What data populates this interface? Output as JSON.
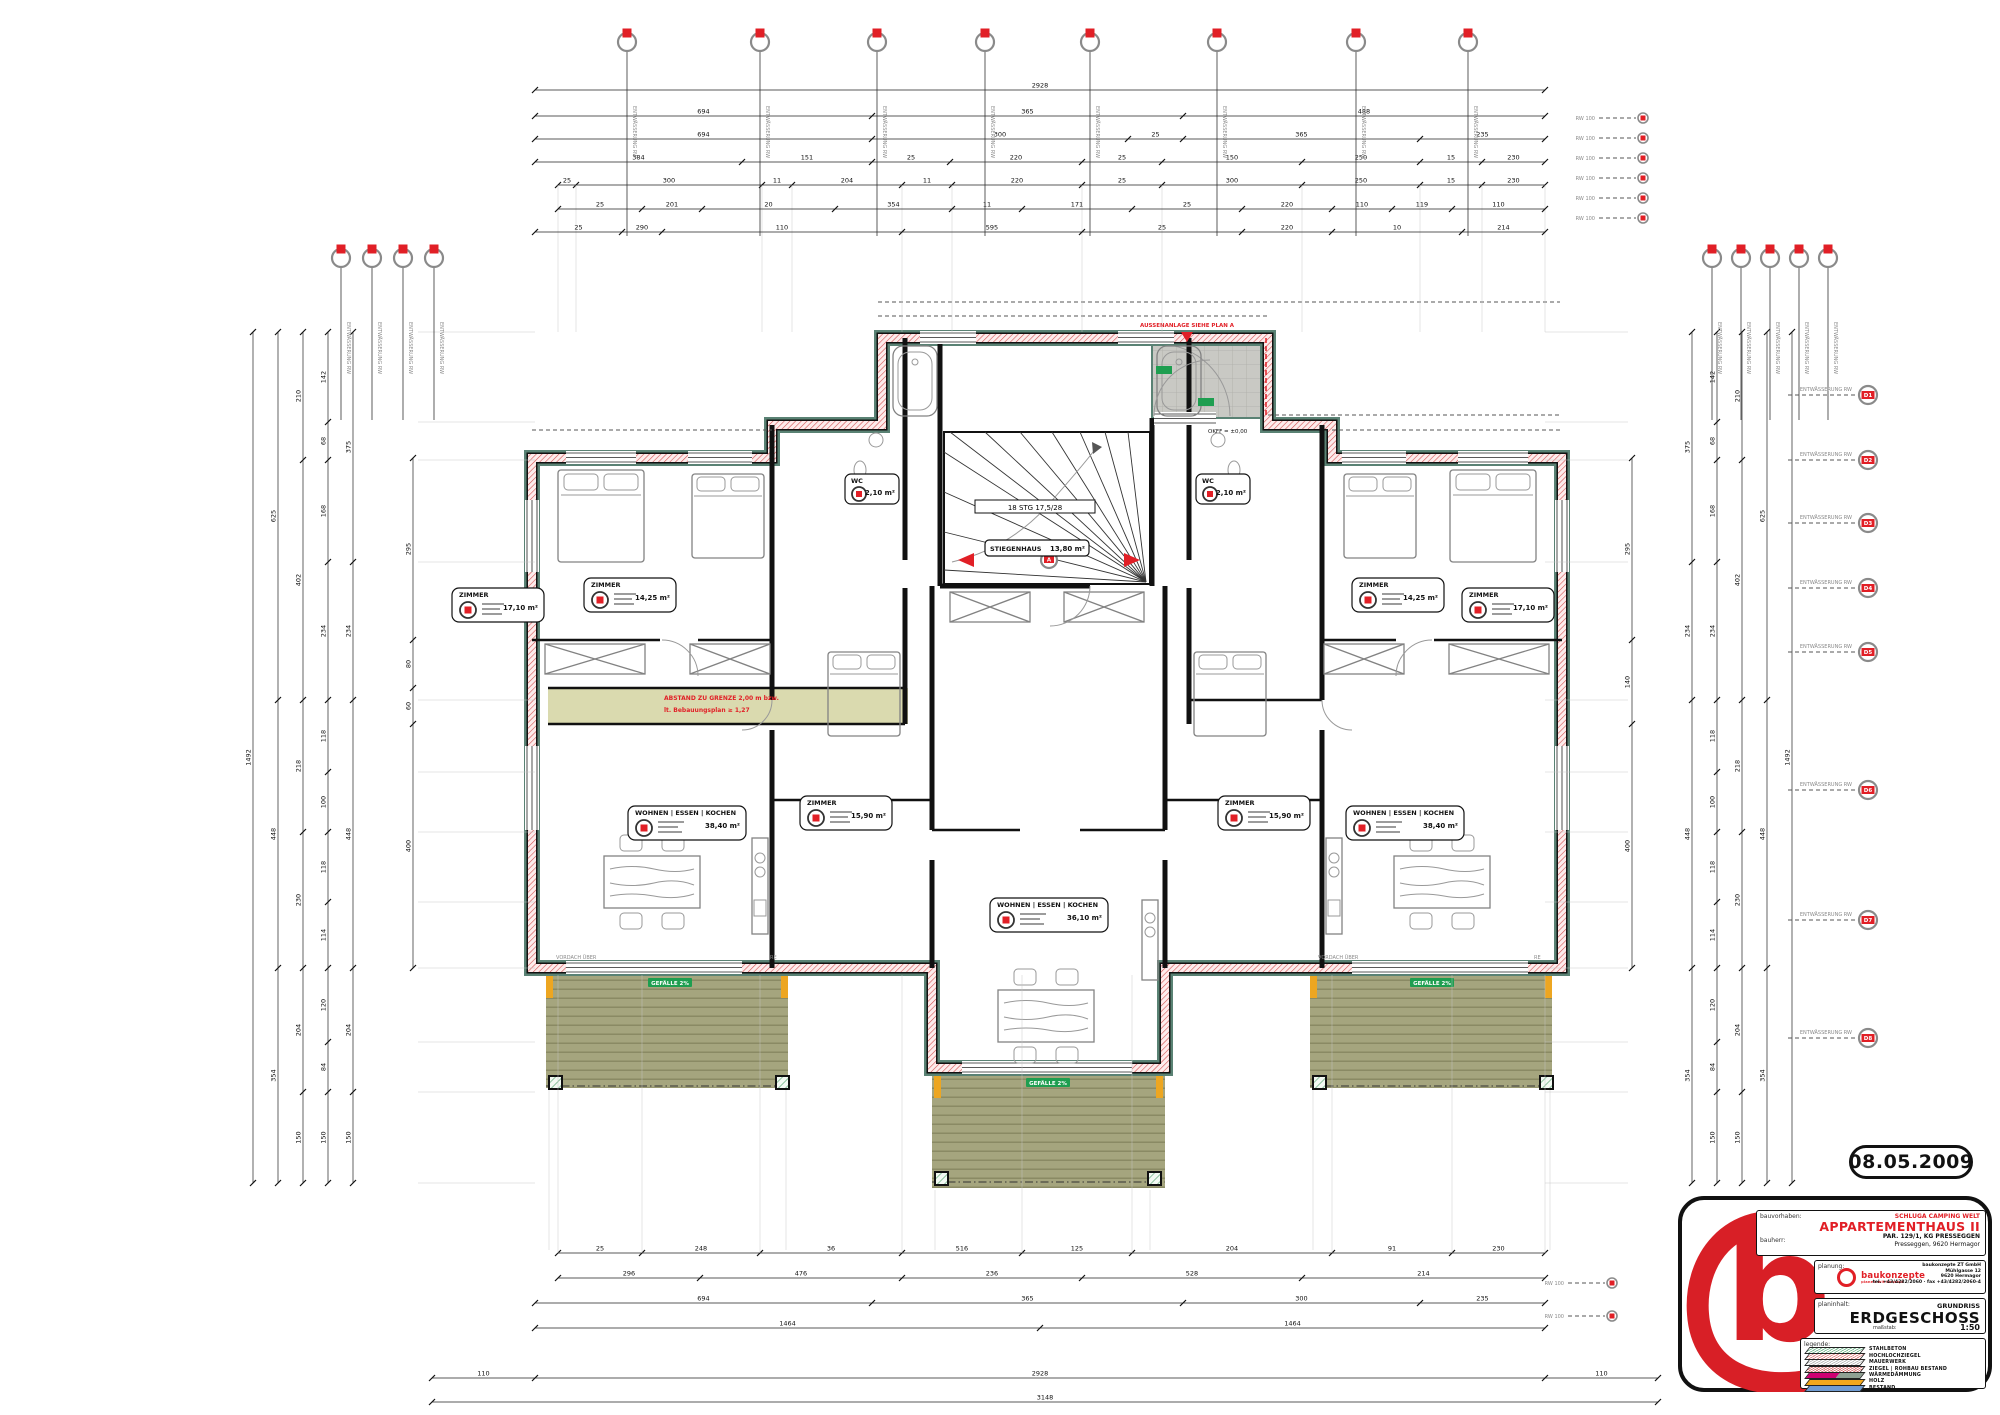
{
  "meta": {
    "date_stamp": "08.05.2009"
  },
  "titleblock": {
    "bauvorhaben_label": "bauvorhaben:",
    "bauherr_label": "bauherr:",
    "client": "SCHLUGA CAMPING WELT",
    "project_title": "APPARTEMENTHAUS II",
    "project_sub1": "PAR. 129/1, KG PRESSEGGEN",
    "project_sub2": "Presseggen, 9620 Hermagor",
    "planung_label": "planung:",
    "logo_text": "baukonzepte",
    "logo_sub": "planen mit konzept",
    "firm_line1": "baukonzepte ZT GmbH",
    "firm_line2": "Mühlgasse 12",
    "firm_line3": "9620 Hermagor",
    "firm_line4": "tel. +43/4282/2060 · fax +43/4282/2060-4",
    "planinhalt_label": "planinhalt:",
    "drawing_type": "GRUNDRISS",
    "drawing_title": "ERDGESCHOSS",
    "massstab_label": "maßstab:",
    "scale": "1:50",
    "legende_label": "legende:",
    "legend": [
      {
        "label": "STAHLBETON",
        "color": "#58a978"
      },
      {
        "label": "HOCHLOCHZIEGEL",
        "color": "#d96a6a"
      },
      {
        "label": "MAUERWERK",
        "color": "#ababab"
      },
      {
        "label": "ZIEGEL | ROHBAU BESTAND",
        "color": "#d05050"
      },
      {
        "label": "WÄRMEDÄMMUNG",
        "color": "#cf0072"
      },
      {
        "label": "HOLZ",
        "color": "#f2a71b"
      },
      {
        "label": "BESTAND",
        "color": "#6f9bd1"
      }
    ]
  },
  "annotations": {
    "porch_note": "AUSSENANLAGE SIEHE PLAN A",
    "abstand_line1": "ABSTAND ZU GRENZE 2,00 m bzw.",
    "abstand_line2": "lt. Bebauungsplan ≥ 1,27",
    "stair_label": "18 STG 17,5/28",
    "level_entry": "OKFF = ±0,00",
    "gefaelle_label": "GEFÄLLE 2%",
    "vordach_label": "VORDACH ÜBER",
    "re_label": "RE",
    "stair_marker_code": "A"
  },
  "rooms": [
    {
      "name": "ZIMMER",
      "area": "17,10 m²"
    },
    {
      "name": "ZIMMER",
      "area": "14,25 m²"
    },
    {
      "name": "WC",
      "area": "2,10 m²"
    },
    {
      "name": "WC",
      "area": "2,10 m²"
    },
    {
      "name": "ZIMMER",
      "area": "14,25 m²"
    },
    {
      "name": "ZIMMER",
      "area": "17,10 m²"
    },
    {
      "name": "WOHNEN | ESSEN | KOCHEN",
      "area": "38,40 m²"
    },
    {
      "name": "WOHNEN | ESSEN | KOCHEN",
      "area": "38,40 m²"
    },
    {
      "name": "WOHNEN | ESSEN | KOCHEN",
      "area": "36,10 m²"
    },
    {
      "name": "ZIMMER",
      "area": "15,90 m²"
    },
    {
      "name": "ZIMMER",
      "area": "15,90 m²"
    },
    {
      "name": "STIEGENHAUS",
      "area": "13,80 m²"
    }
  ],
  "markers": {
    "stack_label": "ENTWÄSSERUNG RW",
    "detail_label": "ENTWÄSSERUNG RW",
    "edge_label": "RW 100",
    "top": {
      "y": 42,
      "xs": [
        627,
        760,
        877,
        985,
        1090,
        1217,
        1356,
        1468
      ],
      "to": 236
    },
    "left": {
      "y": 258,
      "xs": [
        341,
        372,
        403,
        434
      ],
      "to": 420
    },
    "right": {
      "y": 258,
      "xs": [
        1712,
        1741,
        1770,
        1799,
        1828
      ],
      "to": 420
    },
    "detail": {
      "x": 1868,
      "ys": [
        395,
        460,
        523,
        588,
        652,
        790,
        920,
        1038
      ],
      "codes": [
        "D1",
        "D2",
        "D3",
        "D4",
        "D5",
        "D6",
        "D7",
        "D8"
      ]
    },
    "edge": [
      {
        "x": 1643,
        "ys": [
          118,
          138,
          158,
          178,
          198,
          218
        ]
      },
      {
        "x": 1612,
        "ys": [
          1283,
          1316
        ]
      }
    ]
  },
  "dims": {
    "top": [
      {
        "y": 90,
        "t": [
          535,
          1545
        ],
        "v": [
          "2928"
        ]
      },
      {
        "y": 116,
        "t": [
          535,
          872,
          1183,
          1545
        ],
        "v": [
          "694",
          "365",
          "488"
        ]
      },
      {
        "y": 139,
        "t": [
          535,
          872,
          1128,
          1183,
          1420,
          1545
        ],
        "v": [
          "694",
          "300",
          "25",
          "365",
          "235"
        ]
      },
      {
        "y": 162,
        "t": [
          535,
          742,
          872,
          950,
          1082,
          1162,
          1302,
          1420,
          1482,
          1545
        ],
        "v": [
          "384",
          "151",
          "25",
          "220",
          "25",
          "150",
          "250",
          "15",
          "230"
        ]
      },
      {
        "y": 185,
        "t": [
          558,
          576,
          762,
          792,
          902,
          952,
          1082,
          1162,
          1302,
          1420,
          1482,
          1545
        ],
        "v": [
          "25",
          "300",
          "11",
          "204",
          "11",
          "220",
          "25",
          "300",
          "250",
          "15",
          "230"
        ],
        "ext": true
      },
      {
        "y": 209,
        "t": [
          558,
          642,
          702,
          835,
          952,
          1022,
          1132,
          1242,
          1332,
          1392,
          1452,
          1545
        ],
        "v": [
          "25",
          "201",
          "20",
          "354",
          "11",
          "171",
          "25",
          "220",
          "110",
          "119",
          "110"
        ]
      },
      {
        "y": 232,
        "t": [
          535,
          622,
          662,
          902,
          1082,
          1242,
          1332,
          1462,
          1545
        ],
        "v": [
          "25",
          "290",
          "110",
          "595",
          "25",
          "220",
          "10",
          "214"
        ]
      }
    ],
    "bottom": [
      {
        "y": 1253,
        "t": [
          558,
          642,
          760,
          902,
          1022,
          1132,
          1332,
          1452,
          1545
        ],
        "v": [
          "25",
          "248",
          "36",
          "516",
          "125",
          "204",
          "91",
          "230"
        ],
        "ext": true
      },
      {
        "y": 1278,
        "t": [
          558,
          700,
          902,
          1082,
          1302,
          1545
        ],
        "v": [
          "296",
          "476",
          "236",
          "528",
          "214"
        ]
      },
      {
        "y": 1303,
        "t": [
          535,
          872,
          1183,
          1420,
          1545
        ],
        "v": [
          "694",
          "365",
          "300",
          "235"
        ]
      },
      {
        "y": 1328,
        "t": [
          535,
          1040,
          1545
        ],
        "v": [
          "1464",
          "1464"
        ]
      },
      {
        "y": 1378,
        "t": [
          432,
          535,
          1545,
          1658
        ],
        "v": [
          "110",
          "2928",
          "110"
        ]
      },
      {
        "y": 1402,
        "t": [
          432,
          1658
        ],
        "v": [
          "3148"
        ]
      }
    ],
    "left": [
      {
        "x": 253,
        "t": [
          332,
          1183
        ],
        "v": [
          "1492"
        ]
      },
      {
        "x": 278,
        "t": [
          332,
          700,
          968,
          1183
        ],
        "v": [
          "625",
          "448",
          "354"
        ]
      },
      {
        "x": 303,
        "t": [
          332,
          460,
          700,
          832,
          968,
          1092,
          1183
        ],
        "v": [
          "210",
          "402",
          "218",
          "230",
          "204",
          "150"
        ]
      },
      {
        "x": 328,
        "t": [
          332,
          422,
          460,
          562,
          700,
          772,
          832,
          902,
          968,
          1042,
          1092,
          1183
        ],
        "v": [
          "142",
          "68",
          "168",
          "234",
          "118",
          "100",
          "118",
          "114",
          "120",
          "84",
          "150"
        ],
        "ext": true
      },
      {
        "x": 353,
        "t": [
          332,
          562,
          700,
          968,
          1092,
          1183
        ],
        "v": [
          "375",
          "234",
          "448",
          "204",
          "150"
        ]
      },
      {
        "x": 413,
        "t": [
          458,
          640,
          688,
          724,
          968
        ],
        "v": [
          "295",
          "80",
          "60",
          "400"
        ]
      }
    ],
    "right": [
      {
        "x": 1792,
        "t": [
          332,
          1183
        ],
        "v": [
          "1492"
        ]
      },
      {
        "x": 1767,
        "t": [
          332,
          700,
          968,
          1183
        ],
        "v": [
          "625",
          "448",
          "354"
        ]
      },
      {
        "x": 1742,
        "t": [
          332,
          460,
          700,
          832,
          968,
          1092,
          1183
        ],
        "v": [
          "210",
          "402",
          "218",
          "230",
          "204",
          "150"
        ]
      },
      {
        "x": 1717,
        "t": [
          332,
          422,
          460,
          562,
          700,
          772,
          832,
          902,
          968,
          1042,
          1092,
          1183
        ],
        "v": [
          "142",
          "68",
          "168",
          "234",
          "118",
          "100",
          "118",
          "114",
          "120",
          "84",
          "150"
        ],
        "ext": true
      },
      {
        "x": 1692,
        "t": [
          332,
          562,
          700,
          968,
          1183
        ],
        "v": [
          "375",
          "234",
          "448",
          "354"
        ]
      },
      {
        "x": 1632,
        "t": [
          458,
          640,
          724,
          968
        ],
        "v": [
          "295",
          "140",
          "400"
        ]
      }
    ]
  }
}
